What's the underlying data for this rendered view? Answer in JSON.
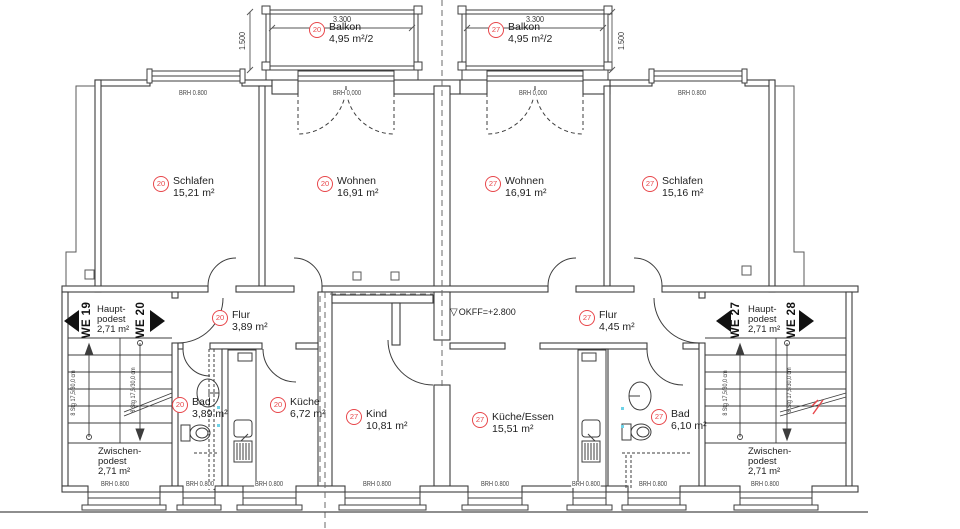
{
  "drawing": {
    "kind": "floor-plan"
  },
  "colors": {
    "accent": "#e8474b",
    "line": "#3d3d3d",
    "fixture_dot": "#6ed3e8"
  },
  "annotations": {
    "level_marker": "OKFF=+2.800",
    "sill": "BRH 0.800",
    "threshold": "BRH 0,000",
    "flight_note": "8 Stg 17,5/30,0 cm"
  },
  "balconies": {
    "left": {
      "unit": "20",
      "name": "Balkon",
      "area": "4,95 m²/2",
      "width_dim": "3.300",
      "depth_dim": "1.500"
    },
    "right": {
      "unit": "27",
      "name": "Balkon",
      "area": "4,95 m²/2",
      "width_dim": "3.300",
      "depth_dim": "1.500"
    }
  },
  "rooms": {
    "schlafen20": {
      "unit": "20",
      "name": "Schlafen",
      "area": "15,21 m²"
    },
    "wohnen20": {
      "unit": "20",
      "name": "Wohnen",
      "area": "16,91 m²"
    },
    "wohnen27": {
      "unit": "27",
      "name": "Wohnen",
      "area": "16,91 m²"
    },
    "schlafen27": {
      "unit": "27",
      "name": "Schlafen",
      "area": "15,16 m²"
    },
    "flur20": {
      "unit": "20",
      "name": "Flur",
      "area": "3,89 m²"
    },
    "flur27": {
      "unit": "27",
      "name": "Flur",
      "area": "4,45 m²"
    },
    "bad20": {
      "unit": "20",
      "name": "Bad",
      "area": "3,89 m²"
    },
    "kueche20": {
      "unit": "20",
      "name": "Küche",
      "area": "6,72 m²"
    },
    "kind27": {
      "unit": "27",
      "name": "Kind",
      "area": "10,81 m²"
    },
    "kueche_essen27": {
      "unit": "27",
      "name": "Küche/Essen",
      "area": "15,51 m²"
    },
    "bad27": {
      "unit": "27",
      "name": "Bad",
      "area": "6,10 m²"
    }
  },
  "stairwells": {
    "left": {
      "unit_left": "WE 19",
      "unit_right": "WE 20",
      "main_landing_l1": "Haupt-",
      "main_landing_l2": "podest",
      "main_landing_area": "2,71 m²",
      "mid_landing_l1": "Zwischen-",
      "mid_landing_l2": "podest",
      "mid_landing_area": "2,71 m²"
    },
    "right": {
      "unit_left": "WE 27",
      "unit_right": "WE 28",
      "main_landing_l1": "Haupt-",
      "main_landing_l2": "podest",
      "main_landing_area": "2,71 m²",
      "mid_landing_l1": "Zwischen-",
      "mid_landing_l2": "podest",
      "mid_landing_area": "2,71 m²"
    }
  }
}
